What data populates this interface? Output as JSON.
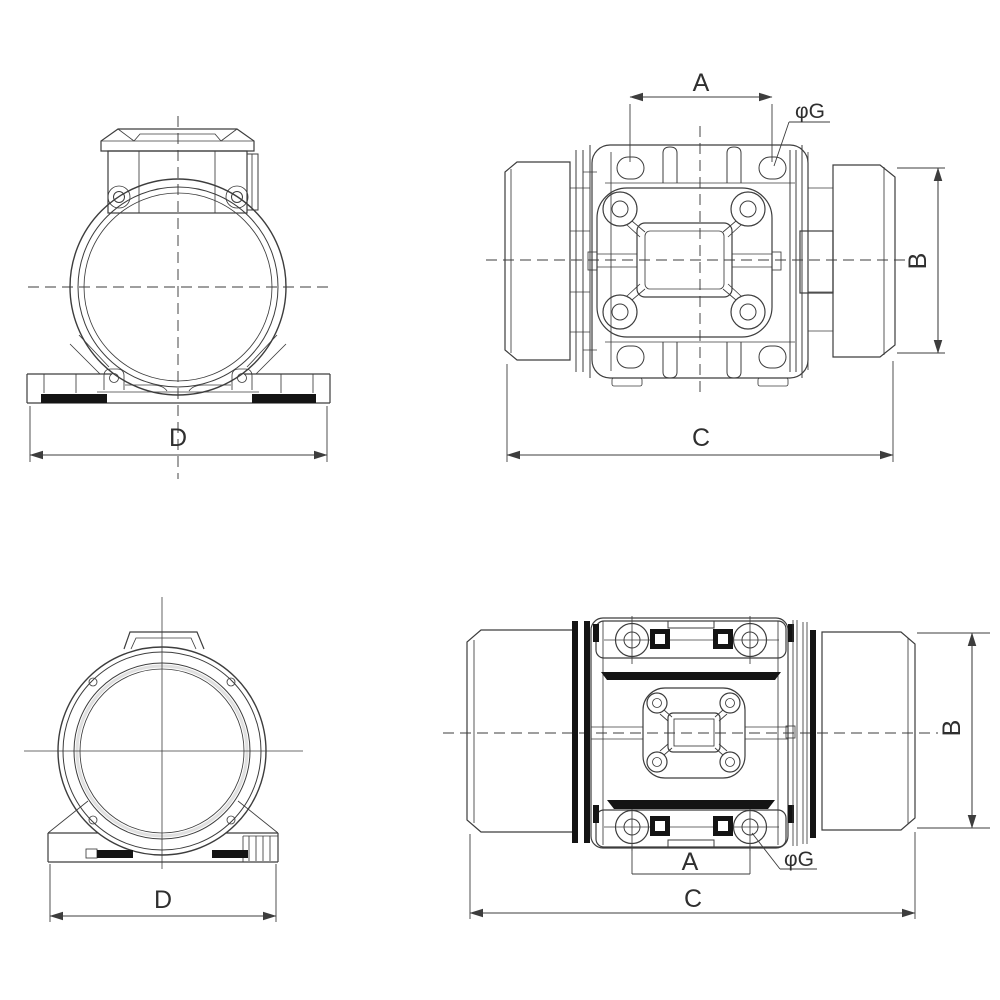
{
  "colors": {
    "background": "#ffffff",
    "line": "#3d3d3d",
    "dark": "#141414",
    "text": "#2f2f2f"
  },
  "views": {
    "front_top": {
      "dim_base_width": "D"
    },
    "side_top": {
      "dim_bolt_spacing": "A",
      "dim_body_height": "B",
      "dim_overall_length": "C",
      "dim_bolt_hole": "φG"
    },
    "front_bottom": {
      "dim_base_width": "D"
    },
    "side_bottom": {
      "dim_bolt_spacing": "A",
      "dim_body_height": "B",
      "dim_overall_length": "C",
      "dim_bolt_hole": "φG"
    }
  }
}
